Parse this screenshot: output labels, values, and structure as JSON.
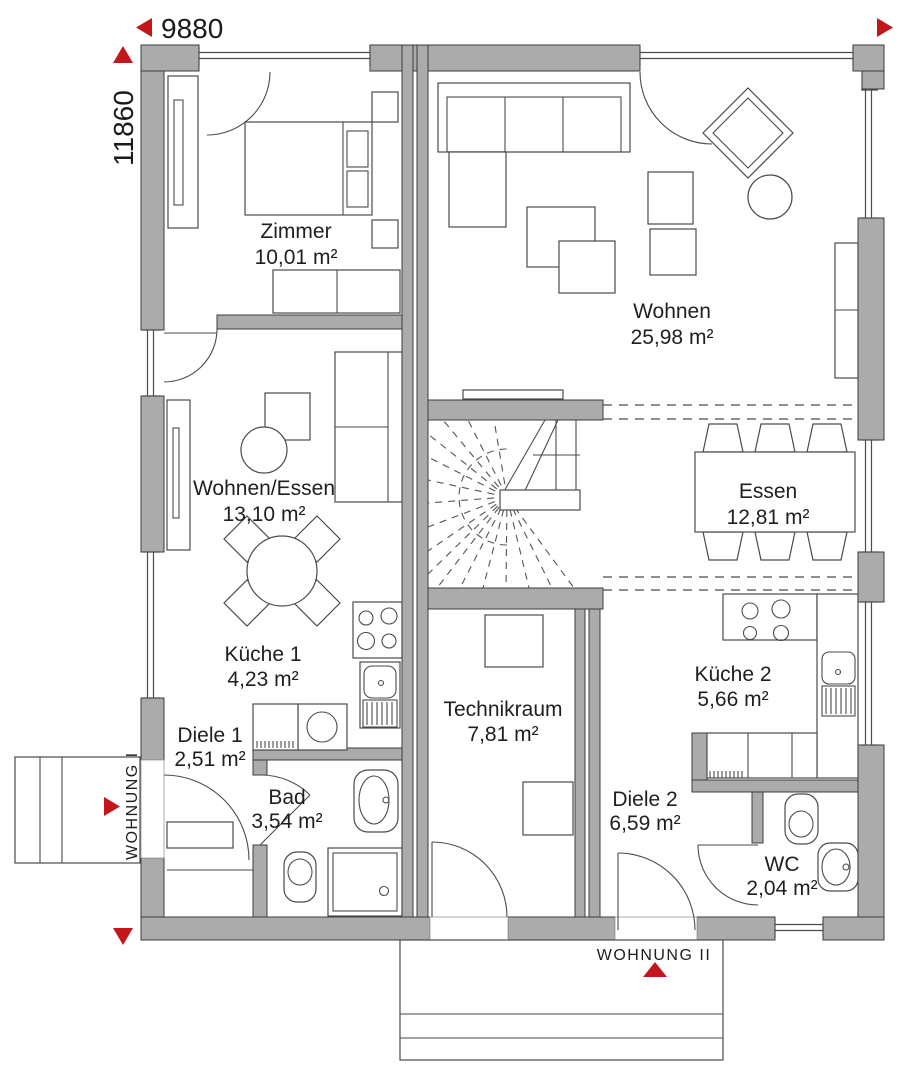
{
  "plan": {
    "dimensions": {
      "width": "9880",
      "height": "11860"
    },
    "apartments": [
      {
        "label": "WOHNUNG I"
      },
      {
        "label": "WOHNUNG II"
      }
    ],
    "rooms": [
      {
        "name": "Zimmer",
        "area": "10,01 m²"
      },
      {
        "name": "Wohnen",
        "area": "25,98 m²"
      },
      {
        "name": "Wohnen/Essen",
        "area": "13,10 m²"
      },
      {
        "name": "Essen",
        "area": "12,81 m²"
      },
      {
        "name": "Küche 1",
        "area": "4,23 m²"
      },
      {
        "name": "Küche 2",
        "area": "5,66 m²"
      },
      {
        "name": "Technikraum",
        "area": "7,81 m²"
      },
      {
        "name": "Diele 1",
        "area": "2,51 m²"
      },
      {
        "name": "Diele 2",
        "area": "6,59 m²"
      },
      {
        "name": "Bad",
        "area": "3,54 m²"
      },
      {
        "name": "WC",
        "area": "2,04 m²"
      }
    ],
    "colors": {
      "wall": "#ababab",
      "wall_outline": "#3d3d3d",
      "line": "#4b4b4b",
      "accent_red": "#c3161c",
      "text": "#1f1f1f",
      "background": "#ffffff"
    }
  }
}
